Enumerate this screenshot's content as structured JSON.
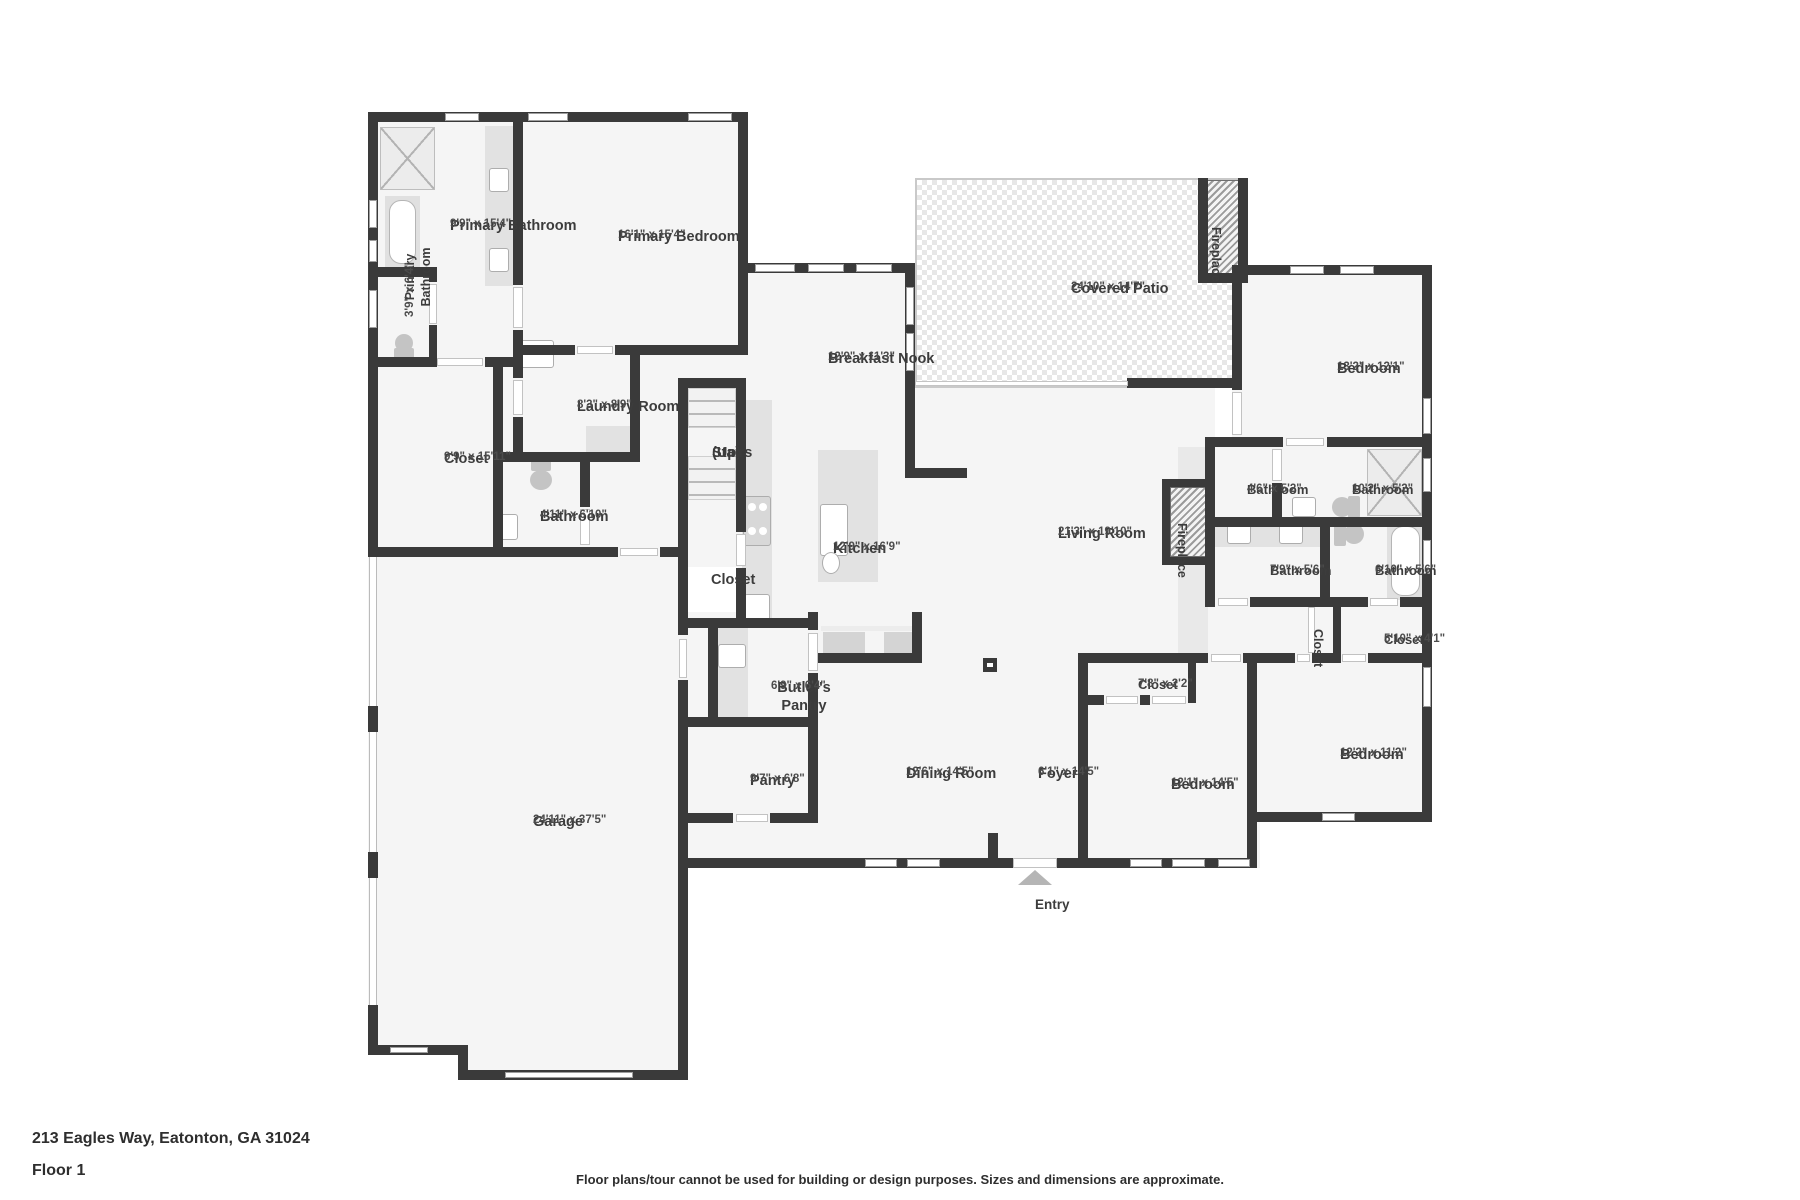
{
  "rooms": {
    "primary_bathroom": {
      "name": "Primary Bathroom",
      "dims": "9'9\" x 15'4\""
    },
    "primary_bedroom": {
      "name": "Primary Bedroom",
      "dims": "16'1\" x 15'4\""
    },
    "primary_bathroom_small": {
      "name": "Primary Bathroom",
      "dims": "3'9\" x 6'4\""
    },
    "closet_primary": {
      "name": "Closet",
      "dims": "9'9\" x 15'11\""
    },
    "laundry": {
      "name": "Laundry Room",
      "dims": "8'3\" x 8'9\""
    },
    "bathroom_hall": {
      "name": "Bathroom",
      "dims": "4'11\" x 6'10\""
    },
    "stairs": {
      "name": "Stairs",
      "line2": "(Up)"
    },
    "closet_stairs": {
      "name": "Closet"
    },
    "breakfast_nook": {
      "name": "Breakfast Nook",
      "dims": "12'9\" x 11'3\""
    },
    "kitchen": {
      "name": "Kitchen",
      "dims": "12'9\" x 16'9\""
    },
    "covered_patio": {
      "name": "Covered Patio",
      "dims": "24'10\" x 14'7\""
    },
    "fireplace_patio": {
      "name": "Fireplace"
    },
    "fireplace_living": {
      "name": "Fireplace"
    },
    "bedroom_tr": {
      "name": "Bedroom",
      "dims": "13'2\" x 12'1\""
    },
    "living_room": {
      "name": "Living Room",
      "dims": "21'3\" x 19'10\""
    },
    "bathroom_1": {
      "name": "Bathroom",
      "dims": "4'6\" x 5'2\""
    },
    "bathroom_2": {
      "name": "Bathroom",
      "dims": "10'2\" x 5'2\""
    },
    "bathroom_3": {
      "name": "Bathroom",
      "dims": "7'9\" x 5'6\""
    },
    "bathroom_4": {
      "name": "Bathroom",
      "dims": "6'10\" x 5'6\""
    },
    "closet_hall_v": {
      "name": "Closet"
    },
    "closet_hall": {
      "name": "Closet",
      "dims": "5'10\" x 4'1\""
    },
    "closet_b1": {
      "name": "Closet",
      "dims": "7'8\" x 2'2\""
    },
    "bedroom_b1": {
      "name": "Bedroom",
      "dims": "12'1\" x 14'5\""
    },
    "bedroom_b2": {
      "name": "Bedroom",
      "dims": "12'2\" x 11'2\""
    },
    "butlers_pantry": {
      "name": "Butler's Pantry",
      "dims": "6'9\" x 6'4\""
    },
    "pantry": {
      "name": "Pantry",
      "dims": "9'7\" x 6'8\""
    },
    "dining": {
      "name": "Dining Room",
      "dims": "12'6\" x 14'5\""
    },
    "foyer": {
      "name": "Foyer",
      "dims": "6'1\" x 14'5\""
    },
    "garage": {
      "name": "Garage",
      "dims": "24'11\" x 37'5\""
    },
    "entry": {
      "name": "Entry"
    }
  },
  "footer": {
    "address": "213 Eagles Way, Eatonton, GA 31024",
    "floor": "Floor 1",
    "disclaimer": "Floor plans/tour cannot be used for building or design purposes. Sizes and dimensions are approximate."
  },
  "colors": {
    "wall": "#3a3a3a",
    "floor": "#f5f5f5",
    "patio_tile": "#e7e7e7",
    "fixture": "#e2e2e2",
    "text": "#3c3c3c"
  }
}
